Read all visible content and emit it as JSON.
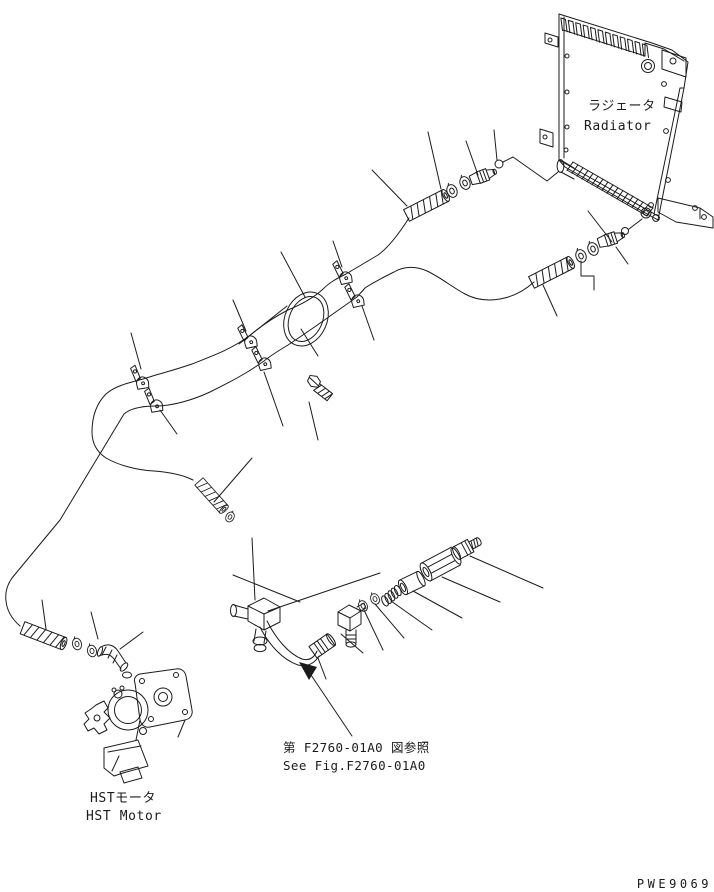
{
  "document": {
    "type": "exploded-parts-diagram",
    "background": "#ffffff",
    "line_color": "#1b1b1b",
    "drawing_code": "PWE9069",
    "labels": {
      "radiator_jp": "ラジェータ",
      "radiator_en": "Radiator",
      "hst_motor_jp": "HSTモータ",
      "hst_motor_en": "HST Motor",
      "figure_ref_jp": "第 F2760-01A0 図参照",
      "figure_ref_en": "See Fig.F2760-01A0"
    },
    "components": [
      "radiator",
      "upper-hose",
      "lower-hose",
      "hose-clamps",
      "hose-loop",
      "flange-bolt",
      "hose-end-sleeves",
      "o-rings",
      "spring",
      "valve-sleeve",
      "valve-body",
      "threaded-plug",
      "tee-block-fitting",
      "bent-tube",
      "swivel-nut",
      "elbow-fitting",
      "hst-motor"
    ]
  }
}
